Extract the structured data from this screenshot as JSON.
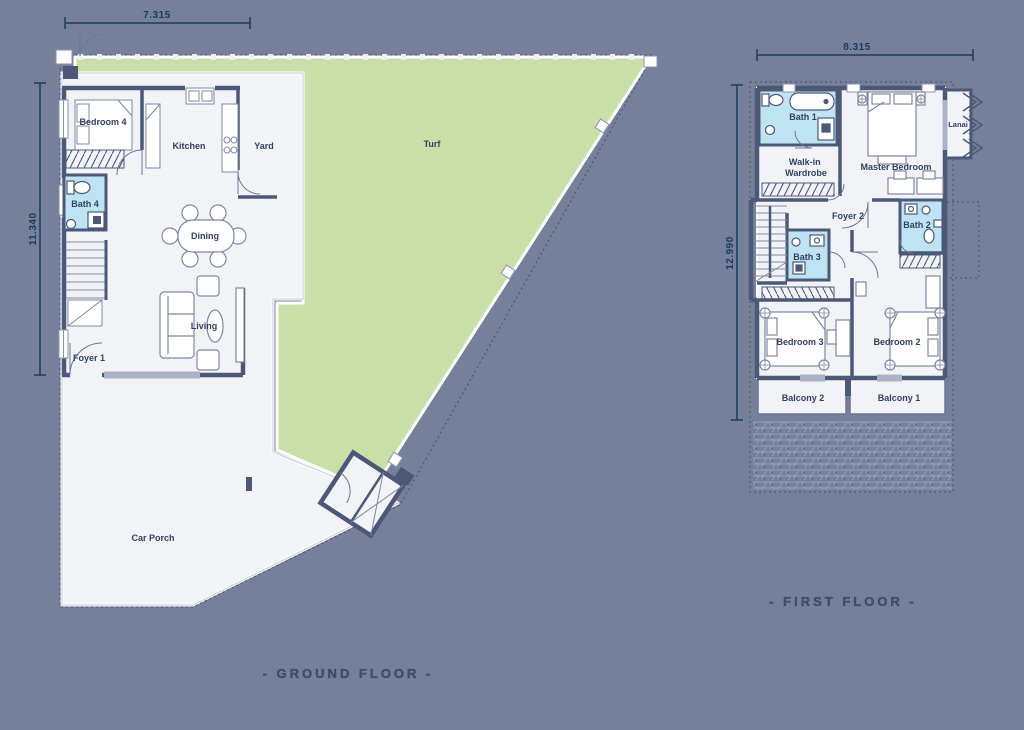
{
  "colors": {
    "background": "#76809b",
    "turf_green": "#c9dfa7",
    "floor_white": "#f2f3f6",
    "wall_navy": "#4c5878",
    "bath_blue": "#bee3f2",
    "dimension_navy": "#1b3a5e",
    "label_navy": "#31415f"
  },
  "ground_floor": {
    "title": "- GROUND FLOOR -",
    "width_dim": "7.315",
    "height_dim": "11.340",
    "rooms": {
      "bedroom4": "Bedroom 4",
      "kitchen": "Kitchen",
      "yard": "Yard",
      "turf": "Turf",
      "bath4": "Bath 4",
      "dining": "Dining",
      "living": "Living",
      "foyer1": "Foyer 1",
      "car_porch": "Car Porch"
    }
  },
  "first_floor": {
    "title": "- FIRST FLOOR -",
    "width_dim": "8.315",
    "height_dim": "12.990",
    "rooms": {
      "bath1": "Bath 1",
      "walkin_line1": "Walk-in",
      "walkin_line2": "Wardrobe",
      "master": "Master Bedroom",
      "lanai": "Lanai",
      "foyer2": "Foyer 2",
      "bath2": "Bath 2",
      "bath3": "Bath 3",
      "bedroom3": "Bedroom 3",
      "bedroom2": "Bedroom 2",
      "balcony2": "Balcony 2",
      "balcony1": "Balcony 1"
    }
  }
}
